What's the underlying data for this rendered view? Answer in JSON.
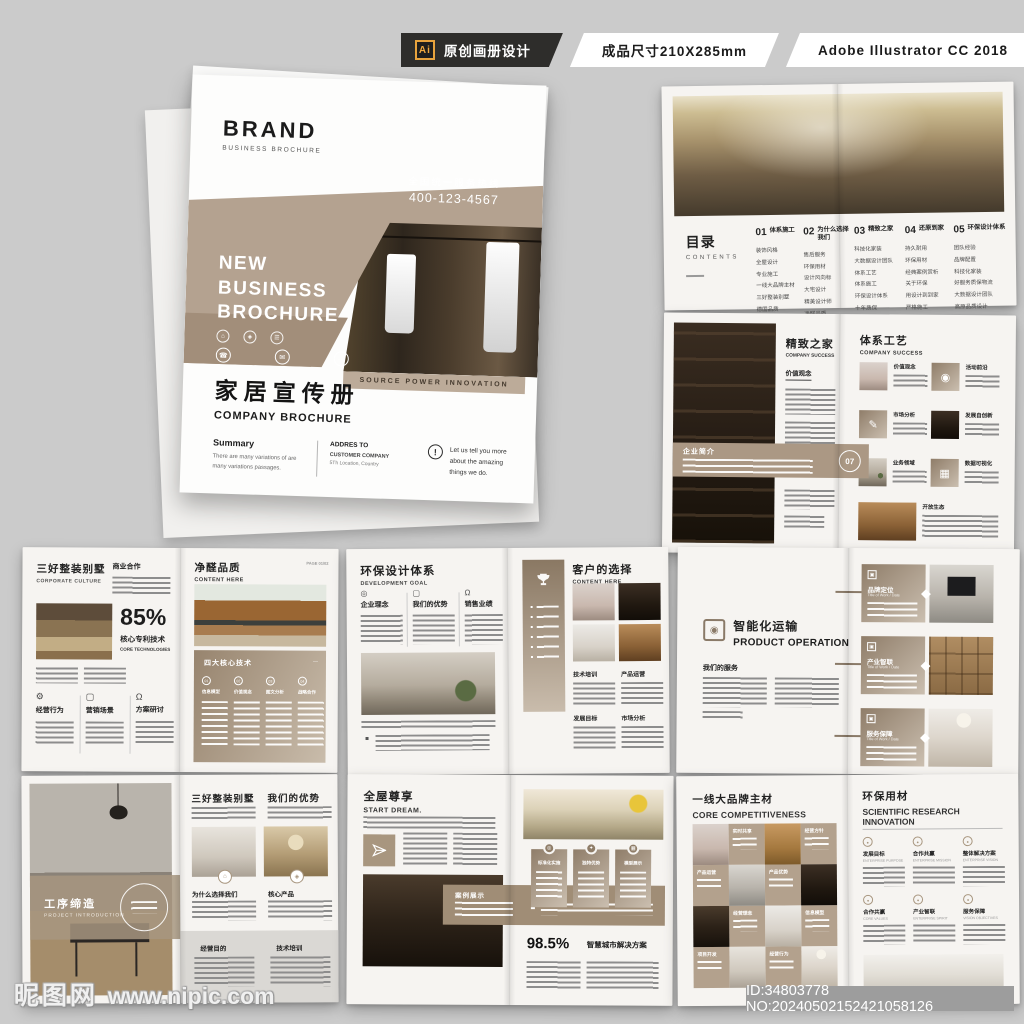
{
  "meta_bar": {
    "ai_badge": "Ai",
    "label_original": "原创画册设计",
    "label_size": "成品尺寸210X285mm",
    "label_software": "Adobe Illustrator CC 2018"
  },
  "watermark": {
    "site_cn": "昵图网",
    "site_url": "www.nipic.com",
    "id_text": "ID:34803778 NO:20240502152421058126"
  },
  "cover": {
    "brand": "BRAND",
    "brand_sub": "BUSINESS BROCHURE",
    "hotline_label": "全国统一服务热线",
    "hotline_number": "400-123-4567",
    "headline": [
      "NEW",
      "BUSINESS",
      "BROCHURE"
    ],
    "title_cn": "家居宣传册",
    "title_en": "COMPANY BROCHURE",
    "tagline": "SOURCE POWER INNOVATION",
    "summary_title": "Summary",
    "summary_text": "There are many variations of  are many variations passages.",
    "address_title": "ADDRES TO",
    "address_company": "CUSTOMER COMPANY",
    "address_location": "5Th Location, Country",
    "note_mark": "!",
    "note": "Let us tell you more about the amazing things we do."
  },
  "contents": {
    "title_cn": "目录",
    "title_en": "CONTENTS",
    "sections": [
      {
        "num": "01",
        "title": "体系施工",
        "items": [
          "装饰风格",
          "全屋设计",
          "专业施工",
          "一线大品牌主材",
          "三好整装别墅",
          "德国品质"
        ]
      },
      {
        "num": "02",
        "title": "为什么选择我们",
        "items": [
          "售后服务",
          "环保用材",
          "设计风向标",
          "大宅设计",
          "精美设计师",
          "净醛品质"
        ]
      },
      {
        "num": "03",
        "title": "精致之家",
        "items": [
          "科技化家装",
          "大数据设计团队",
          "体系工艺",
          "体系施工",
          "环保设计体系",
          "十年质保"
        ]
      },
      {
        "num": "04",
        "title": "还原到家",
        "items": [
          "持久耐用",
          "环保用材",
          "经典案例赏析",
          "关于环保",
          "用设计到到家",
          "严格施工"
        ]
      },
      {
        "num": "05",
        "title": "环保设计体系",
        "items": [
          "团队经验",
          "品牌配置",
          "科技化家装",
          "好服务质保物流",
          "大数据设计团队",
          "高原品质设计"
        ]
      }
    ]
  },
  "success": {
    "left_title_cn": "精致之家",
    "left_title_en": "COMPANY SUCCESS",
    "left_sub": "价值观念",
    "band_label": "企业简介",
    "band_num": "07",
    "right_title_cn": "体系工艺",
    "right_title_en": "COMPANY SUCCESS",
    "grid": [
      "价值观念",
      "活动前沿",
      "市场分析",
      "发展自创新",
      "业务领域",
      "数据可视化"
    ],
    "grid_last": "开放生态"
  },
  "villa": {
    "title_cn": "三好整装别墅",
    "title_en": "CORPORATE CULTURE",
    "sub": "商业合作",
    "percent": "85%",
    "percent_cn": "核心专利技术",
    "percent_en": "CORE TECHNOLOGIES",
    "columns": [
      "经营行为",
      "营销场景",
      "方案研讨"
    ],
    "right_title_cn": "净醛品质",
    "right_title_en": "CONTENT HERE",
    "page_label": "PAGE 01/02",
    "panel_title": "四大核心技术",
    "panel_items": [
      {
        "num": "01",
        "label": "信息模型"
      },
      {
        "num": "02",
        "label": "价值观念"
      },
      {
        "num": "03",
        "label": "图文分析"
      },
      {
        "num": "04",
        "label": "战略合作"
      }
    ]
  },
  "eco": {
    "title_cn": "环保设计体系",
    "title_en": "DEVELOPMENT GOAL",
    "columns": [
      "企业理念",
      "我们的优势",
      "销售业绩"
    ],
    "right_title_cn": "客户的选择",
    "right_title_en": "CONTENT HERE",
    "labels": [
      "技术培训",
      "产品运营",
      "发展目标",
      "市场分析"
    ]
  },
  "operation": {
    "title_cn": "智能化运输",
    "title_en": "PRODUCT OPERATION",
    "sub": "我们的服务",
    "cards": [
      {
        "title": "品牌定位",
        "sub": "Title of Work / Date"
      },
      {
        "title": "产业智联",
        "sub": "Title of Work / Date"
      },
      {
        "title": "服务保障",
        "sub": "Title of Work / Date"
      }
    ]
  },
  "intro": {
    "band_cn": "工序缔造",
    "band_en": "PROJECT INTRODUCTION",
    "right_title_1": "三好整装别墅",
    "right_title_2": "我们的优势",
    "mid_labels": [
      "为什么选择我们",
      "核心产品"
    ],
    "bottom_labels": [
      "经营目的",
      "技术培训"
    ]
  },
  "dream": {
    "title_cn": "全屋尊享",
    "title_en": "START DREAM.",
    "band_label": "案例展示",
    "cards": [
      "标准化实施",
      "独特优势",
      "模型展示"
    ],
    "percent": "98.5%",
    "percent_label": "智慧城市解决方案"
  },
  "core": {
    "title_cn": "一线大品牌主材",
    "title_en": "CORE COMPETITIVENESS",
    "tiles": [
      "实时共享",
      "经营方针",
      "产品运营",
      "产品优势",
      "经营理念",
      "信息模型",
      "项目开发",
      "经营行为"
    ],
    "right_title_cn": "环保用材",
    "right_title_en1": "SCIENTIFIC RESEARCH",
    "right_title_en2": "INNOVATION",
    "items": [
      {
        "cn": "发展目标",
        "en": "ENTERPRISE PURPOSE"
      },
      {
        "cn": "合作共赢",
        "en": "ENTERPRISE MISSION"
      },
      {
        "cn": "整体解决方案",
        "en": "ENTERPRISE VISION"
      },
      {
        "cn": "合作共赢",
        "en": "CORE VALUES"
      },
      {
        "cn": "产业智联",
        "en": "ENTERPRISE SPIRIT"
      },
      {
        "cn": "服务保障",
        "en": "VISION OBJECTIVES"
      }
    ]
  },
  "colors": {
    "accent_tan": "#b4a290",
    "accent_tan_dark": "#a28e7a",
    "page_bg": "#f6f4f1",
    "canvas_bg": "#cbcbcb",
    "ai_orange": "#e8a33d",
    "id_band_bg": "#9d9d9d"
  }
}
